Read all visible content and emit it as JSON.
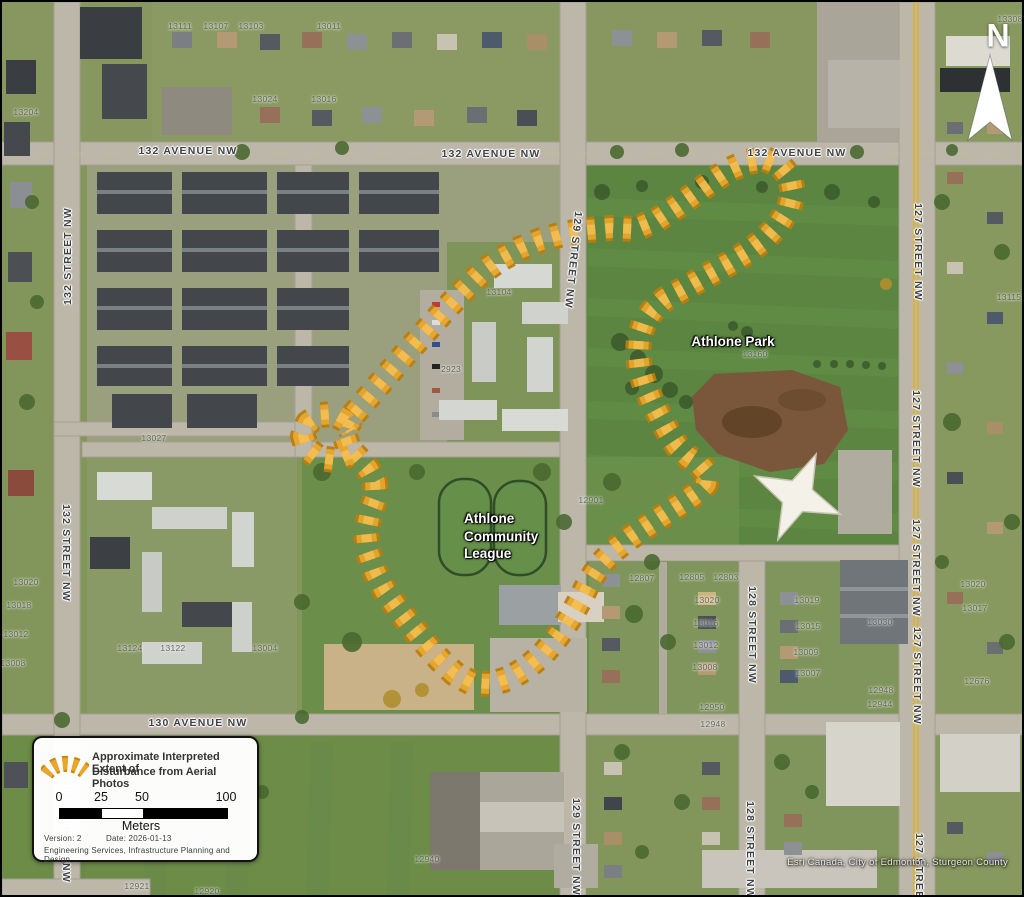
{
  "map": {
    "park_label": "Athlone Park",
    "community_league_label": "Athlone\nCommunity\nLeague",
    "attribution": "Esri Canada, City of Edmonton, Sturgeon County",
    "north_label": "N",
    "street_labels": [
      {
        "text": "132 AVENUE NW",
        "x": 186,
        "y": 149,
        "rot": 0
      },
      {
        "text": "132 AVENUE NW",
        "x": 489,
        "y": 152,
        "rot": 0
      },
      {
        "text": "132 AVENUE NW",
        "x": 795,
        "y": 151,
        "rot": 0
      },
      {
        "text": "130 AVENUE NW",
        "x": 196,
        "y": 721,
        "rot": 0
      },
      {
        "text": "132 STREET NW",
        "x": 66,
        "y": 254,
        "rot": -90
      },
      {
        "text": "132 STREET NW",
        "x": 64,
        "y": 551,
        "rot": 90
      },
      {
        "text": "132 STREET NW",
        "x": 64,
        "y": 832,
        "rot": 90
      },
      {
        "text": "129 STREET NW",
        "x": 571,
        "y": 258,
        "rot": 96
      },
      {
        "text": "129 STREET NW",
        "x": 574,
        "y": 845,
        "rot": 90
      },
      {
        "text": "128 STREET NW",
        "x": 750,
        "y": 633,
        "rot": 90
      },
      {
        "text": "128 STREET NW",
        "x": 748,
        "y": 848,
        "rot": 90
      },
      {
        "text": "127 STREET NW",
        "x": 916,
        "y": 250,
        "rot": 90
      },
      {
        "text": "127 STREET NW",
        "x": 914,
        "y": 437,
        "rot": 90
      },
      {
        "text": "127 STREET NW",
        "x": 914,
        "y": 566,
        "rot": 90
      },
      {
        "text": "127 STREET NW",
        "x": 915,
        "y": 674,
        "rot": 90
      },
      {
        "text": "127 STREET NW",
        "x": 917,
        "y": 880,
        "rot": 90
      }
    ],
    "house_numbers": [
      {
        "text": "13111",
        "x": 178,
        "y": 24
      },
      {
        "text": "13107",
        "x": 214,
        "y": 24
      },
      {
        "text": "13103",
        "x": 249,
        "y": 24
      },
      {
        "text": "13011",
        "x": 327,
        "y": 24
      },
      {
        "text": "13308",
        "x": 1008,
        "y": 17
      },
      {
        "text": "13204",
        "x": 24,
        "y": 110
      },
      {
        "text": "13024",
        "x": 263,
        "y": 97
      },
      {
        "text": "13016",
        "x": 322,
        "y": 97
      },
      {
        "text": "13104",
        "x": 497,
        "y": 290
      },
      {
        "text": "2923",
        "x": 449,
        "y": 367
      },
      {
        "text": "13027",
        "x": 152,
        "y": 436
      },
      {
        "text": "13020",
        "x": 24,
        "y": 580
      },
      {
        "text": "13018",
        "x": 17,
        "y": 603
      },
      {
        "text": "13012",
        "x": 14,
        "y": 632
      },
      {
        "text": "13008",
        "x": 11,
        "y": 661
      },
      {
        "text": "13124",
        "x": 128,
        "y": 646
      },
      {
        "text": "13122",
        "x": 171,
        "y": 646
      },
      {
        "text": "13004",
        "x": 263,
        "y": 646
      },
      {
        "text": "13160",
        "x": 753,
        "y": 352
      },
      {
        "text": "12901",
        "x": 589,
        "y": 498
      },
      {
        "text": "12807",
        "x": 640,
        "y": 576
      },
      {
        "text": "12805",
        "x": 690,
        "y": 575
      },
      {
        "text": "12803",
        "x": 724,
        "y": 575
      },
      {
        "text": "13020",
        "x": 705,
        "y": 598
      },
      {
        "text": "13016",
        "x": 704,
        "y": 621
      },
      {
        "text": "13012",
        "x": 704,
        "y": 643
      },
      {
        "text": "13008",
        "x": 703,
        "y": 665
      },
      {
        "text": "12950",
        "x": 710,
        "y": 705
      },
      {
        "text": "12948",
        "x": 711,
        "y": 722
      },
      {
        "text": "13019",
        "x": 805,
        "y": 598
      },
      {
        "text": "13015",
        "x": 806,
        "y": 624
      },
      {
        "text": "13009",
        "x": 804,
        "y": 650
      },
      {
        "text": "13007",
        "x": 806,
        "y": 671
      },
      {
        "text": "13030",
        "x": 878,
        "y": 620
      },
      {
        "text": "12948",
        "x": 879,
        "y": 688
      },
      {
        "text": "12944",
        "x": 878,
        "y": 702
      },
      {
        "text": "13020",
        "x": 971,
        "y": 582
      },
      {
        "text": "13017",
        "x": 973,
        "y": 606
      },
      {
        "text": "12676",
        "x": 975,
        "y": 679
      },
      {
        "text": "13115",
        "x": 1007,
        "y": 295
      },
      {
        "text": "12940",
        "x": 425,
        "y": 857
      },
      {
        "text": "12921",
        "x": 135,
        "y": 884
      },
      {
        "text": "12920",
        "x": 205,
        "y": 889
      }
    ]
  },
  "legend": {
    "title_line1": "Approximate Interpreted Extent of",
    "title_line2": "Disturbance from Aerial Photos",
    "scale_ticks": [
      "0",
      "25",
      "50",
      "100"
    ],
    "scale_unit": "Meters",
    "version_label": "Version: 2",
    "date_label": "Date: 2026-01-13",
    "dept_label": "Engineering Services, Infrastructure Planning and Design"
  },
  "colors": {
    "boundary_outer": "#B97F10",
    "boundary_mid": "#E9A62C",
    "boundary_inner": "#F7BE4D",
    "road": "#BCB7A9",
    "road_yellow_line": "#D9B23C",
    "park_green": "#5B8540",
    "grass": "#82965C",
    "dirt": "#7A573A",
    "label_gray": "#3E4246"
  },
  "boundary": {
    "dash": "8 10",
    "main_loop": [
      [
        352,
        412
      ],
      [
        370,
        391
      ],
      [
        388,
        370
      ],
      [
        406,
        349
      ],
      [
        424,
        329
      ],
      [
        442,
        309
      ],
      [
        460,
        290
      ],
      [
        478,
        272
      ],
      [
        497,
        258
      ],
      [
        517,
        247
      ],
      [
        539,
        238
      ],
      [
        561,
        232
      ],
      [
        585,
        228
      ],
      [
        609,
        226
      ],
      [
        633,
        227
      ],
      [
        655,
        218
      ],
      [
        673,
        206
      ],
      [
        691,
        193
      ],
      [
        709,
        180
      ],
      [
        727,
        168
      ],
      [
        745,
        160
      ],
      [
        763,
        157
      ],
      [
        778,
        163
      ],
      [
        788,
        175
      ],
      [
        791,
        190
      ],
      [
        787,
        206
      ],
      [
        777,
        222
      ],
      [
        763,
        237
      ],
      [
        746,
        250
      ],
      [
        728,
        261
      ],
      [
        710,
        271
      ],
      [
        694,
        280
      ],
      [
        678,
        289
      ],
      [
        663,
        297
      ],
      [
        651,
        308
      ],
      [
        642,
        321
      ],
      [
        637,
        336
      ],
      [
        636,
        352
      ],
      [
        638,
        368
      ],
      [
        643,
        384
      ],
      [
        650,
        400
      ],
      [
        658,
        415
      ],
      [
        666,
        430
      ],
      [
        675,
        444
      ],
      [
        686,
        455
      ],
      [
        698,
        463
      ],
      [
        705,
        471
      ],
      [
        704,
        482
      ],
      [
        695,
        491
      ],
      [
        682,
        500
      ],
      [
        665,
        511
      ],
      [
        647,
        523
      ],
      [
        629,
        535
      ],
      [
        612,
        548
      ],
      [
        598,
        563
      ],
      [
        587,
        580
      ],
      [
        578,
        598
      ],
      [
        568,
        616
      ],
      [
        556,
        634
      ],
      [
        542,
        651
      ],
      [
        526,
        665
      ],
      [
        508,
        676
      ],
      [
        489,
        682
      ],
      [
        470,
        681
      ],
      [
        453,
        672
      ],
      [
        438,
        658
      ],
      [
        424,
        642
      ],
      [
        410,
        625
      ],
      [
        396,
        607
      ],
      [
        383,
        589
      ],
      [
        373,
        570
      ],
      [
        366,
        550
      ],
      [
        364,
        530
      ],
      [
        368,
        511
      ],
      [
        374,
        495
      ],
      [
        373,
        480
      ],
      [
        366,
        467
      ],
      [
        356,
        456
      ],
      [
        347,
        446
      ],
      [
        343,
        435
      ],
      [
        346,
        423
      ]
    ],
    "knot_curl": [
      [
        348,
        452
      ],
      [
        333,
        458
      ],
      [
        317,
        456
      ],
      [
        305,
        447
      ],
      [
        301,
        434
      ],
      [
        306,
        421
      ],
      [
        318,
        413
      ],
      [
        332,
        412
      ],
      [
        343,
        418
      ],
      [
        349,
        429
      ]
    ]
  }
}
